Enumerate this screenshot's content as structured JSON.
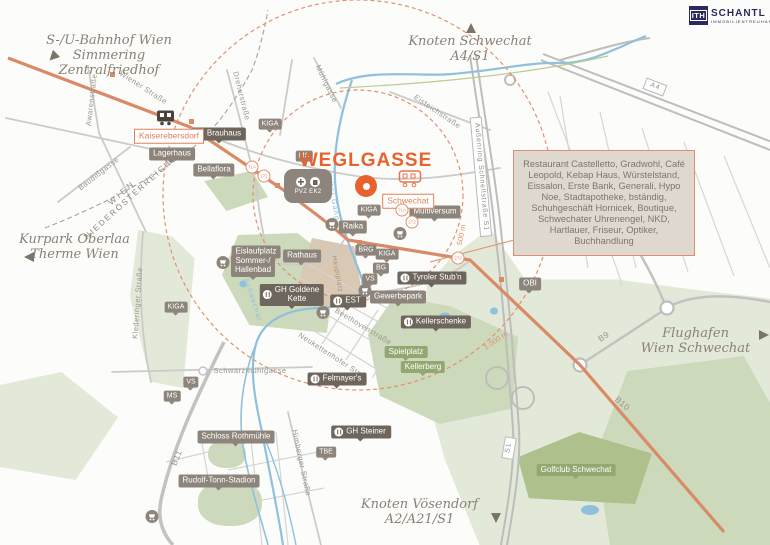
{
  "brand": {
    "logo_square": "ITH",
    "name": "SCHANTL",
    "subtitle": "IMMOBILIENTREUHAND"
  },
  "title": {
    "text": "WEGLGASSE"
  },
  "info_box": {
    "text": "Restaurant Castelletto, Gradwohl, Café Leopold, Kebap Haus, Würstelstand, Eissalon, Erste Bank, Generali, Hypo Noe, Stadtapotheke,  bständig, Schuhgeschäft Hornicek, Boutique, Schwechater Uhrenengel, NKD, Hartlauer, Friseur, Optiker, Buchhandlung"
  },
  "region_border": {
    "line1": "WIEN",
    "line2": "NIEDERÖSTERREICH"
  },
  "poi": {
    "pvz_label": "PVZ EK2"
  },
  "destinations": [
    {
      "id": "simmering",
      "lines": [
        "S-/U-Bahnhof Wien Simmering",
        "Zentralfriedhof"
      ],
      "arrow": "southwest"
    },
    {
      "id": "knoten-schwechat",
      "lines": [
        "Knoten Schwechat",
        "A4/S1"
      ],
      "arrow": "up"
    },
    {
      "id": "kurpark",
      "lines": [
        "Kurpark Oberlaa",
        "Therme Wien"
      ],
      "arrow": "left"
    },
    {
      "id": "flughafen",
      "lines": [
        "Flughafen",
        "Wien Schwechat"
      ],
      "arrow": "right"
    },
    {
      "id": "voesendorf",
      "lines": [
        "Knoten Vösendorf",
        "A2/A21/S1"
      ],
      "arrow": "down"
    }
  ],
  "colors": {
    "accent_orange": "#E8622D",
    "road_orange": "#D98A66",
    "dashed_ring": "#E0926F",
    "label_gray": "#8D857B",
    "restaurant_gray": "#6E665C",
    "green_label": "#93A871",
    "green_light": "#E3E9D9",
    "green_medium": "#CDD9BB",
    "river_blue": "#8FC0DC",
    "logo_navy": "#2B2A5E",
    "infobox_bg": "#DED8CF"
  },
  "map_labels": [
    {
      "type": "pin",
      "text": "KIGA",
      "x": 270,
      "y": 124
    },
    {
      "type": "pin",
      "text": "KIGA",
      "x": 176,
      "y": 307
    },
    {
      "type": "pin",
      "text": "KIGA",
      "x": 369,
      "y": 210
    },
    {
      "type": "pin",
      "text": "KIGA",
      "x": 387,
      "y": 254
    },
    {
      "type": "pin",
      "text": "MS",
      "x": 304,
      "y": 156
    },
    {
      "type": "pin",
      "text": "MS",
      "x": 172,
      "y": 396
    },
    {
      "type": "pin",
      "text": "VS",
      "x": 370,
      "y": 279
    },
    {
      "type": "pin",
      "text": "VS",
      "x": 191,
      "y": 382
    },
    {
      "type": "pin",
      "text": "BG",
      "x": 381,
      "y": 268
    },
    {
      "type": "pin",
      "text": "BRG",
      "x": 366,
      "y": 250
    },
    {
      "type": "pin",
      "text": "TBE",
      "x": 326,
      "y": 452
    },
    {
      "type": "tag",
      "text": "Lagerhaus",
      "x": 172,
      "y": 154
    },
    {
      "type": "tag",
      "text": "Bellaflora",
      "x": 214,
      "y": 170
    },
    {
      "type": "tag",
      "text": "Raika",
      "x": 353,
      "y": 227
    },
    {
      "type": "tag",
      "text": "Eislaufplatz",
      "x": 256,
      "y": 252
    },
    {
      "type": "tag",
      "text": "Sommer-/\nHallenbad",
      "x": 253,
      "y": 266
    },
    {
      "type": "tag",
      "text": "Rathaus",
      "x": 302,
      "y": 256
    },
    {
      "type": "tag",
      "text": "Gewerbepark",
      "x": 398,
      "y": 297
    },
    {
      "type": "tag",
      "text": "Multiversum",
      "x": 435,
      "y": 212
    },
    {
      "type": "tag",
      "text": "OBI",
      "x": 530,
      "y": 284
    },
    {
      "type": "tag",
      "text": "Schloss Rothmühle",
      "x": 236,
      "y": 437
    },
    {
      "type": "tag",
      "text": "Rudolf-Tonn-Stadion",
      "x": 219,
      "y": 481
    },
    {
      "type": "rest",
      "text": "Brauhaus",
      "x": 219,
      "y": 134
    },
    {
      "type": "rest",
      "text": "GH Goldene\nKette",
      "x": 292,
      "y": 295
    },
    {
      "type": "rest",
      "text": "EST",
      "x": 348,
      "y": 301
    },
    {
      "type": "rest",
      "text": "Tyroler Stub'n",
      "x": 432,
      "y": 278
    },
    {
      "type": "rest",
      "text": "Kellerschenke",
      "x": 436,
      "y": 322
    },
    {
      "type": "rest",
      "text": "Felmayer's",
      "x": 337,
      "y": 379
    },
    {
      "type": "rest",
      "text": "GH Steiner",
      "x": 361,
      "y": 432
    },
    {
      "type": "glabel",
      "text": "Spielplatz",
      "x": 406,
      "y": 352
    },
    {
      "type": "glabel",
      "text": "Kellerberg",
      "x": 423,
      "y": 367
    },
    {
      "type": "glabel",
      "text": "Golfclub Schwechat",
      "x": 576,
      "y": 470
    },
    {
      "type": "obox",
      "text": "Kaiserebersdorf",
      "x": 169,
      "y": 136
    },
    {
      "type": "obox",
      "text": "Schwechat",
      "x": 408,
      "y": 201
    },
    {
      "type": "street",
      "text": "Wiener Straße",
      "x": 143,
      "y": 88,
      "rot": 33
    },
    {
      "type": "street",
      "text": "Awarenstraße",
      "x": 92,
      "y": 100,
      "rot": -83
    },
    {
      "type": "street",
      "text": "Baudißgasse",
      "x": 99,
      "y": 174,
      "rot": -38
    },
    {
      "type": "street",
      "text": "Dreherstraße",
      "x": 241,
      "y": 96,
      "rot": 76
    },
    {
      "type": "street",
      "text": "Mühlgasse",
      "x": 326,
      "y": 84,
      "rot": 64
    },
    {
      "type": "street",
      "text": "Eisteichstraße",
      "x": 437,
      "y": 112,
      "rot": 34
    },
    {
      "type": "street",
      "text": "Klederinger Straße",
      "x": 138,
      "y": 303,
      "rot": -86
    },
    {
      "type": "street",
      "text": "Beethovenstraße",
      "x": 363,
      "y": 327,
      "rot": 31
    },
    {
      "type": "street",
      "text": "Neukettenhofer Str.",
      "x": 330,
      "y": 355,
      "rot": 33
    },
    {
      "type": "street",
      "text": "Schwarzmühlgasse",
      "x": 250,
      "y": 371,
      "rot": 0
    },
    {
      "type": "street",
      "text": "Himberger Straße",
      "x": 301,
      "y": 463,
      "rot": 78
    },
    {
      "type": "riverlbl",
      "text": "Kalter Gang",
      "x": 332,
      "y": 196,
      "rot": 80
    },
    {
      "type": "riverlbl",
      "text": "Schwechat",
      "x": 252,
      "y": 300,
      "rot": 72
    },
    {
      "type": "roadbox",
      "text": "A4",
      "x": 655,
      "y": 87,
      "rot": 21
    },
    {
      "type": "roadbox",
      "text": "S1",
      "x": 509,
      "y": 448,
      "rot": -80
    },
    {
      "type": "roadbox",
      "text": "Außenring Schnellstraße S1",
      "x": 481,
      "y": 177,
      "rot": 85
    },
    {
      "type": "roadtext",
      "text": "B9",
      "x": 604,
      "y": 337,
      "rot": -35
    },
    {
      "type": "roadtext",
      "text": "B10",
      "x": 622,
      "y": 404,
      "rot": 40
    },
    {
      "type": "roadtext",
      "text": "B11",
      "x": 177,
      "y": 458,
      "rot": -68
    },
    {
      "type": "distance",
      "text": "500 m",
      "x": 462,
      "y": 235,
      "rot": -78
    },
    {
      "type": "distance",
      "text": "1.000 m",
      "x": 496,
      "y": 341,
      "rot": -33
    },
    {
      "type": "brown",
      "text": "Hauptplatz",
      "x": 337,
      "y": 274,
      "rot": 80
    },
    {
      "type": "badge",
      "text": "71A",
      "x": 252,
      "y": 167
    },
    {
      "type": "badge",
      "text": "272",
      "x": 264,
      "y": 176
    },
    {
      "type": "badge",
      "text": "71A",
      "x": 402,
      "y": 210
    },
    {
      "type": "badge",
      "text": "272",
      "x": 412,
      "y": 222
    },
    {
      "type": "badge",
      "text": "272",
      "x": 458,
      "y": 258
    }
  ],
  "poi_icons": [
    {
      "type": "train-dark",
      "x": 166,
      "y": 120
    },
    {
      "type": "train-orange",
      "x": 411,
      "y": 181
    },
    {
      "type": "cart",
      "x": 400,
      "y": 236
    },
    {
      "type": "cart",
      "x": 365,
      "y": 293
    },
    {
      "type": "cart",
      "x": 323,
      "y": 315
    },
    {
      "type": "cart",
      "x": 152,
      "y": 519
    },
    {
      "type": "cart",
      "x": 332,
      "y": 227
    },
    {
      "type": "cart",
      "x": 223,
      "y": 265
    }
  ]
}
